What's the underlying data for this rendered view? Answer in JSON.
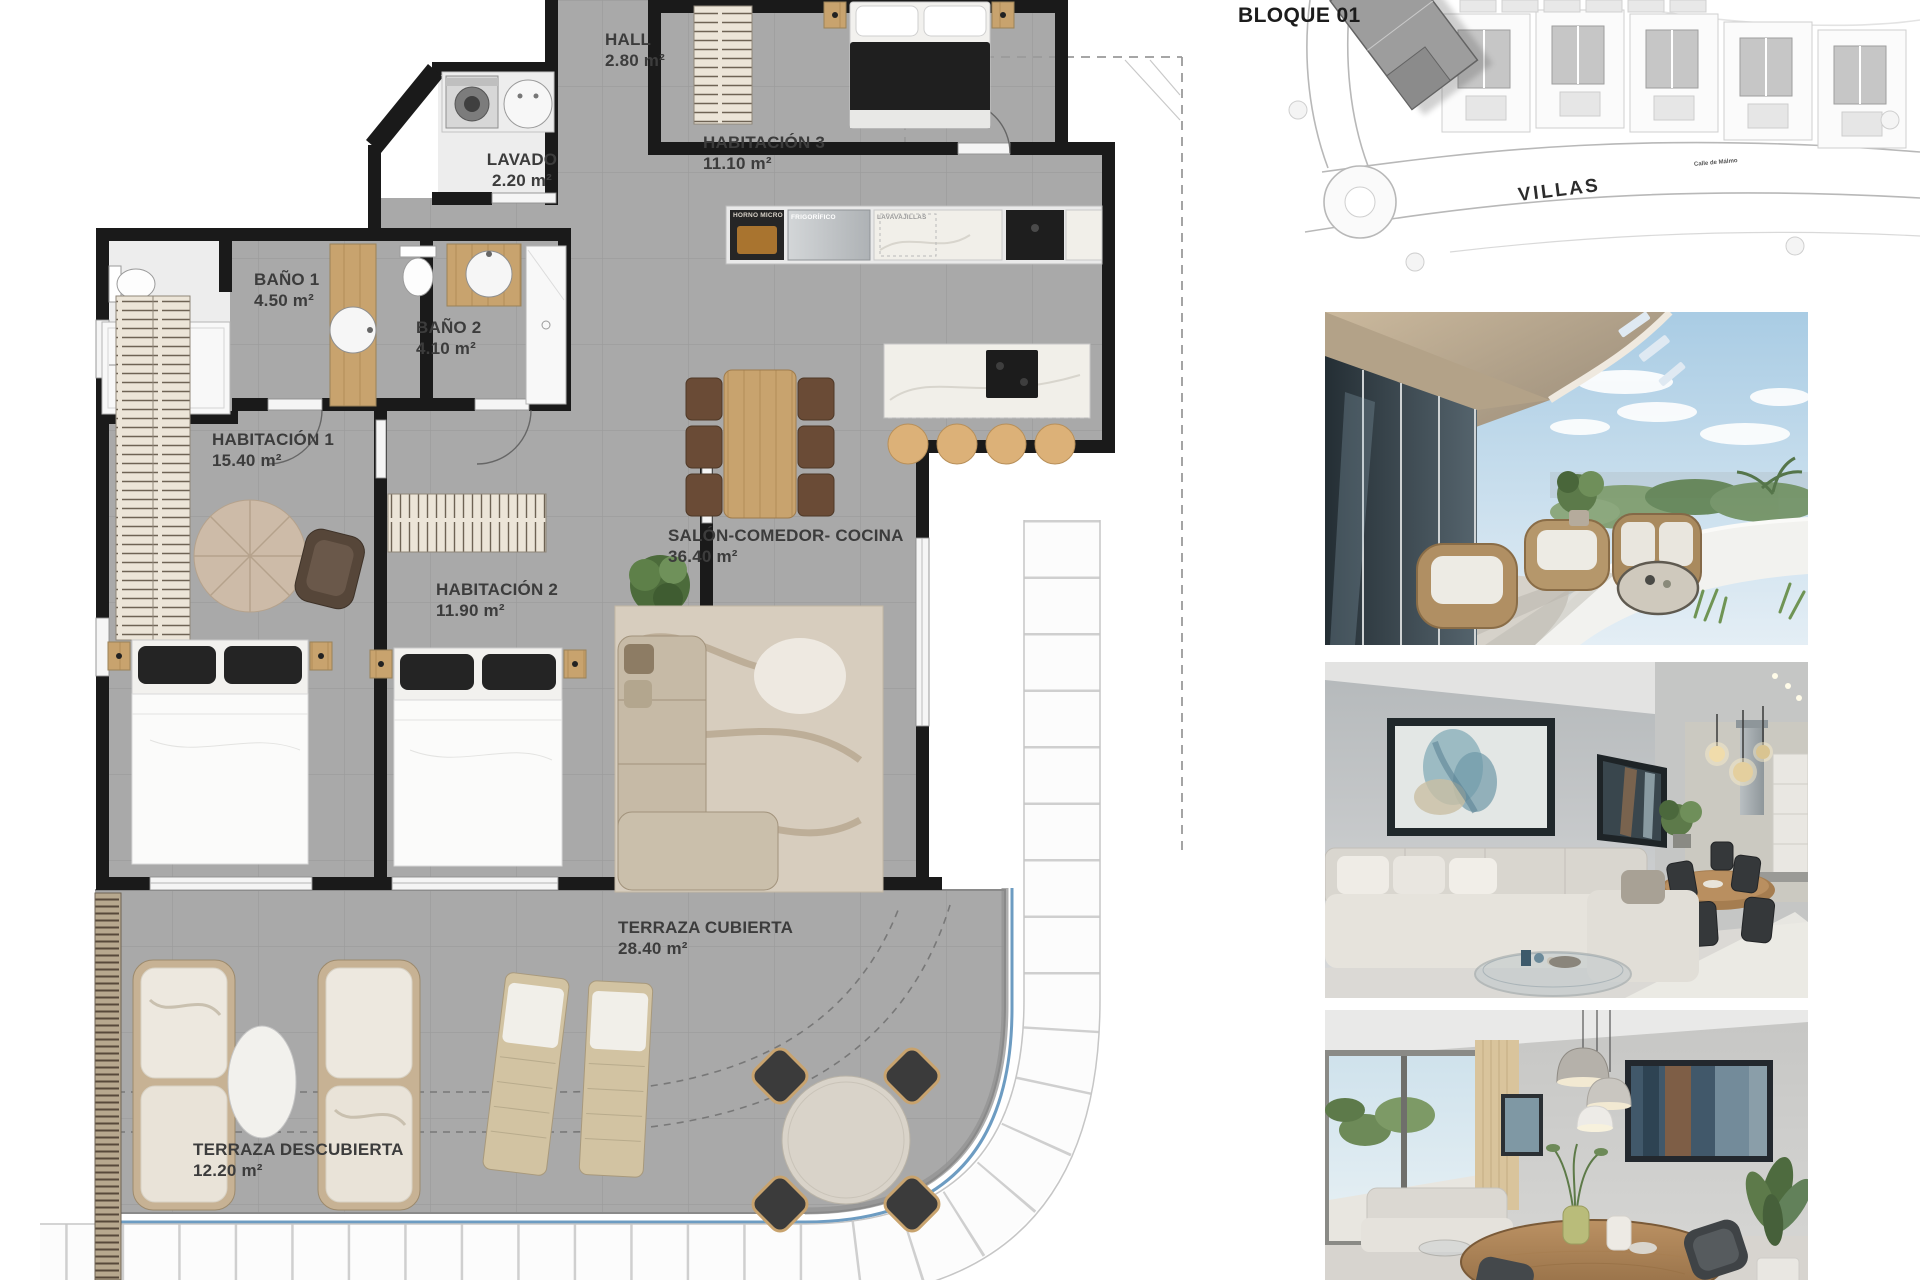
{
  "floor_plan": {
    "rooms": [
      {
        "id": "hall",
        "name": "HALL",
        "area": "2.80 m²"
      },
      {
        "id": "lavado",
        "name": "LAVADO",
        "area": "2.20 m²"
      },
      {
        "id": "habitacion-3",
        "name": "HABITACIÓN 3",
        "area": "11.10 m²"
      },
      {
        "id": "bano-1",
        "name": "BAÑO 1",
        "area": "4.50 m²"
      },
      {
        "id": "bano-2",
        "name": "BAÑO 2",
        "area": "4.10 m²"
      },
      {
        "id": "habitacion-1",
        "name": "HABITACIÓN 1",
        "area": "15.40 m²"
      },
      {
        "id": "habitacion-2",
        "name": "HABITACIÓN 2",
        "area": "11.90 m²"
      },
      {
        "id": "salon-comedor-cocina",
        "name": "SALÓN-COMEDOR- COCINA",
        "area": "36.40 m²"
      },
      {
        "id": "terraza-cubierta",
        "name": "TERRAZA CUBIERTA",
        "area": "28.40 m²"
      },
      {
        "id": "terraza-descubierta",
        "name": "TERRAZA DESCUBIERTA",
        "area": "12.20 m²"
      }
    ],
    "kitchen_labels": [
      "HORNO MICRO",
      "FRIGORÍFICO",
      "LAVAVAJILLAS"
    ]
  },
  "site_plan": {
    "block_label": "BLOQUE 01",
    "street_name": "VILLAS",
    "small_street_label": "Calle de Málmo"
  },
  "photos": [
    {
      "id": "terrace-render"
    },
    {
      "id": "living-room-render"
    },
    {
      "id": "dining-room-render"
    }
  ],
  "colors": {
    "floor_tile": "#a9a9a9",
    "wall": "#1a1a1a",
    "wood": "#c8a36e",
    "terrace_edge_blue": "#6d9cc2",
    "label_text": "#3c3c3c"
  }
}
